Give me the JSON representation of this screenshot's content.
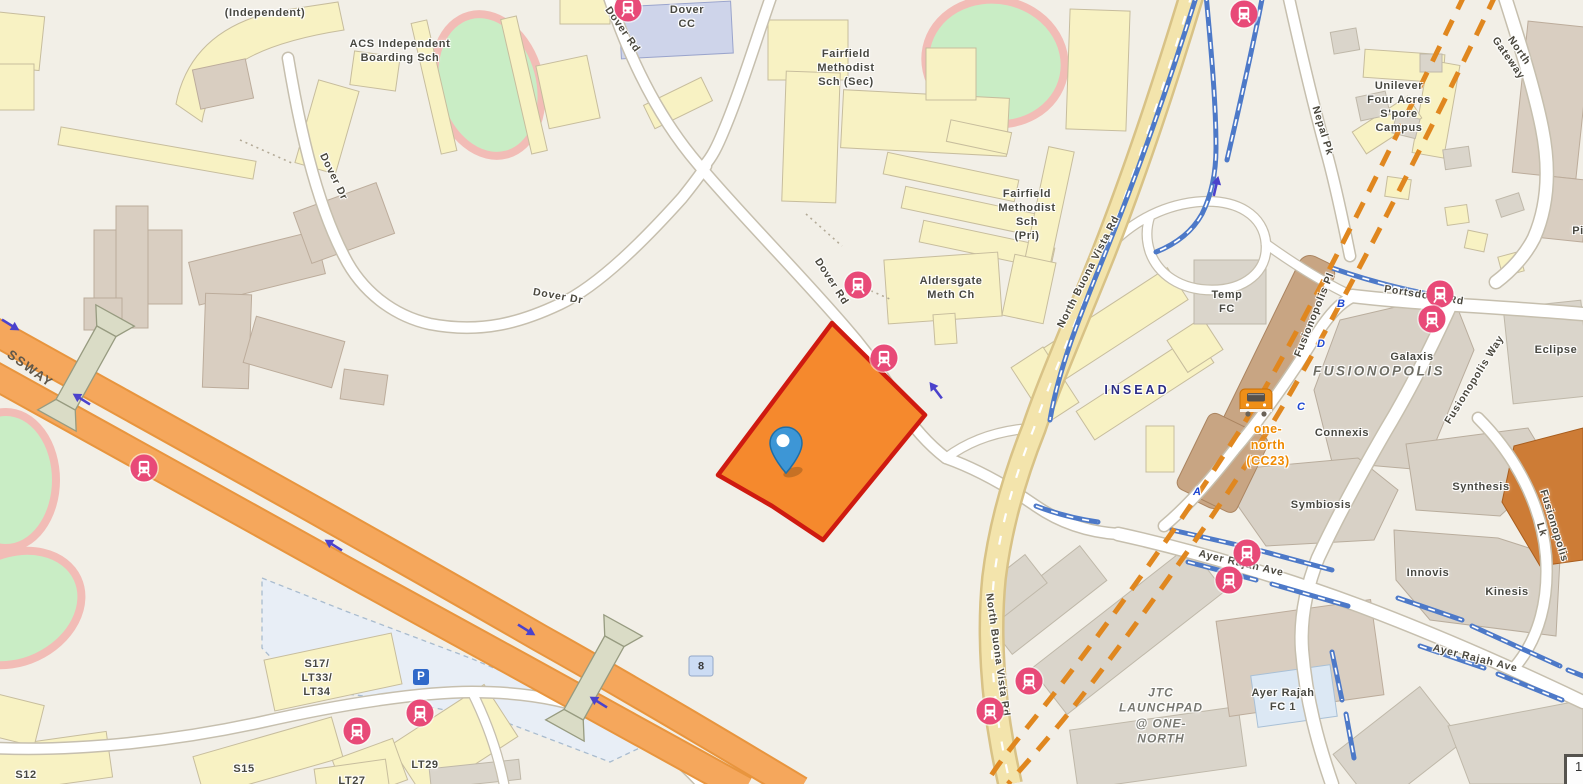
{
  "map": {
    "colors": {
      "highlight_fill": "#F5892D",
      "highlight_stroke": "#CF1A10",
      "marker": "#3D96D6",
      "bus_stop": "#E84A78",
      "mrt_line": "#4D79C8",
      "construction_line": "#E0871F",
      "expressway": "#F5A75C",
      "major_road": "#F3E4AC",
      "one_north_text": "#EF8A00",
      "insead_text": "#2B2D85"
    },
    "labels": [
      {
        "text": "(Independent)",
        "x": 265,
        "y": 13,
        "r": 0,
        "cls": "place"
      },
      {
        "text": "ACS Independent\nBoarding Sch",
        "x": 400,
        "y": 51,
        "r": 0,
        "cls": "place"
      },
      {
        "text": "Dover Dr",
        "x": 333,
        "y": 177,
        "r": 64,
        "cls": "road"
      },
      {
        "text": "Dover Dr",
        "x": 558,
        "y": 297,
        "r": 10,
        "cls": "road"
      },
      {
        "text": "Dover\nCC",
        "x": 687,
        "y": 17,
        "r": 0,
        "cls": "place"
      },
      {
        "text": "Dover Rd",
        "x": 622,
        "y": 30,
        "r": 55,
        "cls": "road"
      },
      {
        "text": "Dover Rd",
        "x": 831,
        "y": 282,
        "r": 57,
        "cls": "road"
      },
      {
        "text": "Fairfield\nMethodist\nSch (Sec)",
        "x": 846,
        "y": 68,
        "r": 0,
        "cls": "place"
      },
      {
        "text": "Fairfield\nMethodist\nSch\n(Pri)",
        "x": 1027,
        "y": 215,
        "r": 0,
        "cls": "place"
      },
      {
        "text": "Aldersgate\nMeth Ch",
        "x": 951,
        "y": 288,
        "r": 0,
        "cls": "place"
      },
      {
        "text": "North Buona Vista Rd",
        "x": 1089,
        "y": 272,
        "r": -63,
        "cls": "road"
      },
      {
        "text": "INSEAD",
        "x": 1137,
        "y": 390,
        "r": 0,
        "cls": "insead"
      },
      {
        "text": "Temp\nFC",
        "x": 1227,
        "y": 302,
        "r": 0,
        "cls": "place"
      },
      {
        "text": "Unilever\nFour Acres\nS'pore\nCampus",
        "x": 1399,
        "y": 107,
        "r": 0,
        "cls": "place"
      },
      {
        "text": "Nepal Pk",
        "x": 1322,
        "y": 131,
        "r": 73,
        "cls": "road"
      },
      {
        "text": "North Gateway",
        "x": 1513,
        "y": 55,
        "r": 55,
        "cls": "road"
      },
      {
        "text": "Pi",
        "x": 1578,
        "y": 231,
        "r": 0,
        "cls": "place"
      },
      {
        "text": "Portsdown Rd",
        "x": 1424,
        "y": 296,
        "r": 9,
        "cls": "road"
      },
      {
        "text": "Galaxis",
        "x": 1412,
        "y": 357,
        "r": 0,
        "cls": "place"
      },
      {
        "text": "FUSIONOPOLIS",
        "x": 1379,
        "y": 371,
        "r": 0,
        "cls": "district"
      },
      {
        "text": "Connexis",
        "x": 1342,
        "y": 433,
        "r": 0,
        "cls": "place"
      },
      {
        "text": "one-\nnorth\n(CC23)",
        "x": 1268,
        "y": 445,
        "r": 0,
        "cls": "mrt-name"
      },
      {
        "text": "Fusionopolis Pl",
        "x": 1315,
        "y": 315,
        "r": -68,
        "cls": "road"
      },
      {
        "text": "Fusionopolis Way",
        "x": 1475,
        "y": 380,
        "r": -58,
        "cls": "road"
      },
      {
        "text": "Eclipse",
        "x": 1556,
        "y": 350,
        "r": 0,
        "cls": "place"
      },
      {
        "text": "Symbiosis",
        "x": 1321,
        "y": 505,
        "r": 0,
        "cls": "place"
      },
      {
        "text": "Synthesis",
        "x": 1481,
        "y": 487,
        "r": 0,
        "cls": "place"
      },
      {
        "text": "Innovis",
        "x": 1428,
        "y": 573,
        "r": 0,
        "cls": "place"
      },
      {
        "text": "Kinesis",
        "x": 1507,
        "y": 592,
        "r": 0,
        "cls": "place"
      },
      {
        "text": "Fusionopolis Lk",
        "x": 1547,
        "y": 528,
        "r": 73,
        "cls": "road"
      },
      {
        "text": "Ayer Rajah Ave",
        "x": 1241,
        "y": 564,
        "r": 13,
        "cls": "road"
      },
      {
        "text": "Ayer Rajah Ave",
        "x": 1475,
        "y": 659,
        "r": 14,
        "cls": "road"
      },
      {
        "text": "JTC\nLAUNCHPAD\n@ ONE-\nNORTH",
        "x": 1161,
        "y": 716,
        "r": 0,
        "cls": "estate"
      },
      {
        "text": "Ayer Rajah\nFC 1",
        "x": 1283,
        "y": 700,
        "r": 0,
        "cls": "place"
      },
      {
        "text": "North Buona Vista Rd",
        "x": 997,
        "y": 655,
        "r": 82,
        "cls": "road"
      },
      {
        "text": "SSWAY",
        "x": 30,
        "y": 369,
        "r": 36,
        "cls": "expwy"
      },
      {
        "text": "S17/\nLT33/\nLT34",
        "x": 317,
        "y": 678,
        "r": 0,
        "cls": "place"
      },
      {
        "text": "S15",
        "x": 244,
        "y": 769,
        "r": 0,
        "cls": "place"
      },
      {
        "text": "S12",
        "x": 26,
        "y": 775,
        "r": 0,
        "cls": "place"
      },
      {
        "text": "LT29",
        "x": 425,
        "y": 765,
        "r": 0,
        "cls": "place"
      },
      {
        "text": "LT27",
        "x": 352,
        "y": 781,
        "r": 0,
        "cls": "place"
      },
      {
        "text": "B",
        "x": 1341,
        "y": 304,
        "r": 0,
        "cls": "exit"
      },
      {
        "text": "D",
        "x": 1321,
        "y": 344,
        "r": 0,
        "cls": "exit"
      },
      {
        "text": "C",
        "x": 1301,
        "y": 407,
        "r": 0,
        "cls": "exit"
      },
      {
        "text": "A",
        "x": 1197,
        "y": 492,
        "r": 0,
        "cls": "exit"
      }
    ],
    "bus_stops": [
      {
        "x": 628,
        "y": 8
      },
      {
        "x": 858,
        "y": 285
      },
      {
        "x": 884,
        "y": 358
      },
      {
        "x": 144,
        "y": 468
      },
      {
        "x": 1244,
        "y": 14
      },
      {
        "x": 1440,
        "y": 294
      },
      {
        "x": 1432,
        "y": 319
      },
      {
        "x": 1247,
        "y": 553
      },
      {
        "x": 1229,
        "y": 580
      },
      {
        "x": 1029,
        "y": 681
      },
      {
        "x": 990,
        "y": 711
      },
      {
        "x": 420,
        "y": 713
      },
      {
        "x": 357,
        "y": 731
      }
    ],
    "arrows": [
      {
        "x": 11,
        "y": 324,
        "r": 32
      },
      {
        "x": 81,
        "y": 400,
        "r": 212
      },
      {
        "x": 333,
        "y": 546,
        "r": 212
      },
      {
        "x": 527,
        "y": 629,
        "r": 32
      },
      {
        "x": 598,
        "y": 703,
        "r": 212
      },
      {
        "x": 935,
        "y": 391,
        "r": 233
      },
      {
        "x": 1215,
        "y": 186,
        "r": 283
      }
    ],
    "route_badge": {
      "text": "8",
      "x": 701,
      "y": 666
    },
    "parking": {
      "label": "P",
      "x": 421,
      "y": 677
    },
    "station": {
      "x": 1256,
      "y": 402,
      "station_code": "CC23"
    },
    "marker": {
      "x": 786,
      "y": 474
    },
    "corner_box": {
      "text": "1",
      "x": 1564,
      "y": 754
    }
  }
}
